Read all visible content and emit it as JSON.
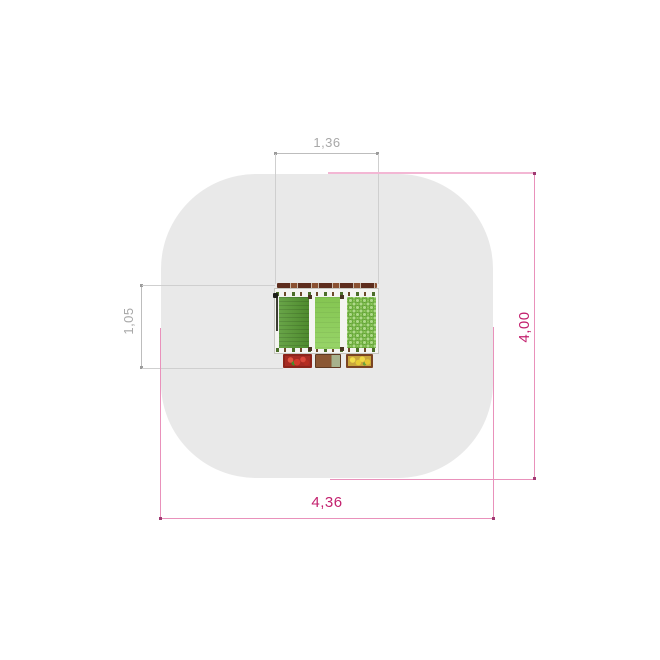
{
  "drawing": {
    "view": "top plan view of playground planting table with safety zone",
    "units": "m"
  },
  "dimensions": {
    "equipment_width": "1,36",
    "equipment_depth": "1,05",
    "zone_height": "4,00",
    "zone_width": "4,36"
  },
  "colors": {
    "background": "#ffffff",
    "safety_zone": "#e9e9e9",
    "gray_line": "#bdbdbd",
    "gray_ext": "#cfcfcf",
    "gray_text": "#a8a8a8",
    "gray_dot": "#9c9c9c",
    "pink_line": "#e991bb",
    "pink_ext": "#f3b7d4",
    "pink_text": "#c3216e",
    "pink_dot": "#a03a72",
    "table_top": "#f4f4f1",
    "table_border": "#c6c6c0",
    "rail_dark": "#5d2d1d",
    "rail_light": "#8a5132",
    "panel_left": "#579a33",
    "panel_mid_1": "#84c551",
    "panel_mid_2": "#97d468",
    "panel_right": "#8fca5c",
    "panel_right_outline": "#63a437",
    "clamp_green": "#4c6e2a",
    "clamp_brown": "#6b4a2a",
    "hose": "#3c3c32",
    "tray_red_border": "#8c241a",
    "tray_red_fill": "#a62a22",
    "tray_soil": "#8a5734",
    "tray_sage": "#a7b28d",
    "tray_soil_border": "#5f3a22",
    "tray_yellow_border": "#7a4423",
    "tray_yellow_fill": "#caa63c"
  }
}
